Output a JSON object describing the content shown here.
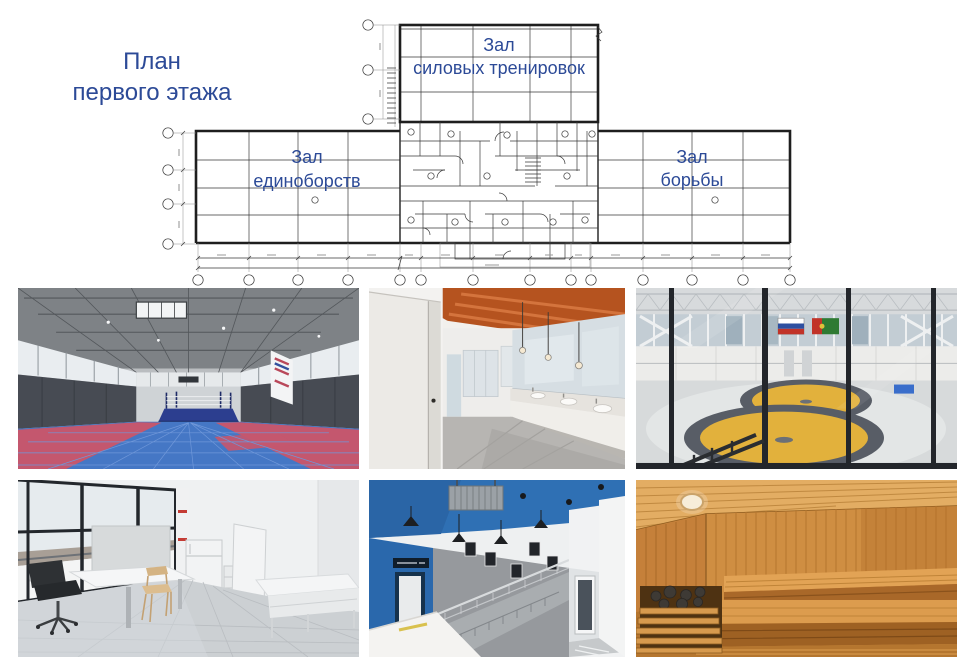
{
  "title": {
    "line1": "План",
    "line2": "первого этажа"
  },
  "floor_plan": {
    "halls": {
      "strength": {
        "line1": "Зал",
        "line2": "силовых тренировок"
      },
      "martial_arts": {
        "line1": "Зал",
        "line2": "единоборств"
      },
      "wrestling": {
        "line1": "Зал",
        "line2": "борьбы"
      }
    }
  },
  "colors": {
    "title_text": "#2c4a97",
    "plan_line": "#3a3a3a",
    "plan_line_heavy": "#1e1e1e",
    "gym_mat_blue": "#4577c5",
    "gym_mat_red": "#c4576e",
    "gym_ring_navy": "#2c3e8f",
    "locker_ceiling_orange": "#b5531f",
    "wrestling_mat_yellow": "#e2b13c",
    "wrestling_ring_gray": "#585d66",
    "lobby_blue": "#2f70b4",
    "sauna_wood_light": "#e3ad63",
    "sauna_wood_mid": "#cf8e42",
    "sauna_wood_dark": "#a96829"
  }
}
